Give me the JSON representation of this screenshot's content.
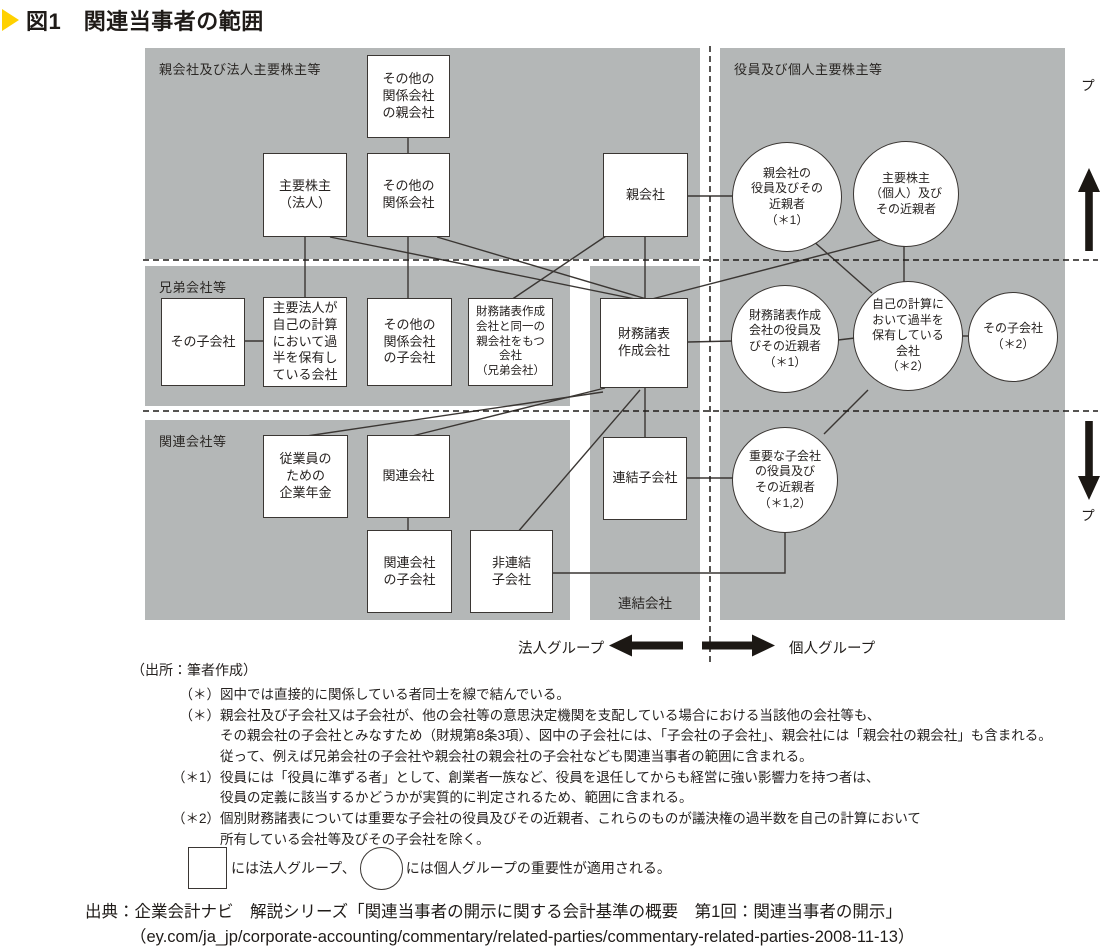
{
  "title": {
    "text": "図1　関連当事者の範囲"
  },
  "regions": {
    "parent_corporate": {
      "label": "親会社及び法人主要株主等"
    },
    "sibling": {
      "label": "兄弟会社等"
    },
    "affiliate": {
      "label": "関連会社等"
    },
    "individual": {
      "label": "役員及び個人主要株主等"
    },
    "consolidated": {
      "label": "連結会社"
    }
  },
  "side_labels": {
    "upper_group": "上位グループ",
    "lower_group": "下位グループ"
  },
  "axis": {
    "corporate_group": "法人グループ",
    "individual_group": "個人グループ"
  },
  "nodes": {
    "sonota_kankei_oya": {
      "shape": "box",
      "label": "その他の\n関係会社\nの親会社"
    },
    "shuyo_kabunushi_hojin": {
      "shape": "box",
      "label": "主要株主\n（法人）"
    },
    "sonota_kankei": {
      "shape": "box",
      "label": "その他の\n関係会社"
    },
    "oyagaisha": {
      "shape": "box",
      "label": "親会社"
    },
    "sono_kogaisha": {
      "shape": "box",
      "label": "その子会社"
    },
    "shuyo_hojin_kahan": {
      "shape": "box",
      "label": "主要法人が\n自己の計算\nにおいて過\n半を保有し\nている会社"
    },
    "sonota_kankei_ko": {
      "shape": "box",
      "label": "その他の\n関係会社\nの子会社"
    },
    "kyodai_gaisha": {
      "shape": "box",
      "label": "財務諸表作成\n会社と同一の\n親会社をもつ\n会社\n（兄弟会社）"
    },
    "zaimu_sakusei": {
      "shape": "box",
      "label": "財務諸表\n作成会社"
    },
    "nenkin": {
      "shape": "box",
      "label": "従業員の\nための\n企業年金"
    },
    "kanren_gaisha": {
      "shape": "box",
      "label": "関連会社"
    },
    "kanren_ko": {
      "shape": "box",
      "label": "関連会社\nの子会社"
    },
    "hirenketsu_ko": {
      "shape": "box",
      "label": "非連結\n子会社"
    },
    "renketsu_ko": {
      "shape": "box",
      "label": "連結子会社"
    },
    "oya_yakuin": {
      "shape": "circle",
      "label": "親会社の\n役員及びその\n近親者\n（＊1）"
    },
    "shuyo_kabunushi_kojin": {
      "shape": "circle",
      "label": "主要株主\n（個人）及び\nその近親者"
    },
    "zaimu_yakuin": {
      "shape": "circle",
      "label": "財務諸表作成\n会社の役員及\nびその近親者\n（＊1）"
    },
    "jiko_keisan_kahan": {
      "shape": "circle",
      "label": "自己の計算に\nおいて過半を\n保有している\n会社\n（＊2）"
    },
    "sono_kogaisha_2": {
      "shape": "circle",
      "label": "その子会社\n（＊2）"
    },
    "juyo_kogaisha_yakuin": {
      "shape": "circle",
      "label": "重要な子会社\nの役員及び\nその近親者\n（＊1,2）"
    }
  },
  "attribution": "（出所：筆者作成）",
  "notes": {
    "rows": [
      {
        "marker": "（＊）",
        "text": "図中では直接的に関係している者同士を線で結んでいる。"
      },
      {
        "marker": "（＊）",
        "text": "親会社及び子会社又は子会社が、他の会社等の意思決定機関を支配している場合における当該他の会社等も、"
      },
      {
        "marker": "",
        "text": "その親会社の子会社とみなすため（財規第8条3項）、図中の子会社には、「子会社の子会社」、親会社には「親会社の親会社」も含まれる。"
      },
      {
        "marker": "",
        "text": "従って、例えば兄弟会社の子会社や親会社の親会社の子会社なども関連当事者の範囲に含まれる。"
      },
      {
        "marker": "（＊1）",
        "text": "役員には「役員に準ずる者」として、創業者一族など、役員を退任してからも経営に強い影響力を持つ者は、"
      },
      {
        "marker": "",
        "text": "役員の定義に該当するかどうかが実質的に判定されるため、範囲に含まれる。"
      },
      {
        "marker": "（＊2）",
        "text": "個別財務諸表については重要な子会社の役員及びその近親者、これらのものが議決権の過半数を自己の計算において"
      },
      {
        "marker": "",
        "text": "所有している会社等及びその子会社を除く。"
      }
    ]
  },
  "legend": {
    "square_text": "には法人グループ、",
    "circle_text": "には個人グループの重要性が適用される。"
  },
  "source": {
    "line1": "出典：企業会計ナビ　解説シリーズ「関連当事者の開示に関する会計基準の概要　第1回：関連当事者の開示」",
    "line2": "（ey.com/ja_jp/corporate-accounting/commentary/related-parties/commentary-related-parties-2008-11-13）"
  },
  "colors": {
    "region_gray": "#b4b7b7",
    "line": "#3a3633",
    "title_marker": "#ffd100"
  }
}
